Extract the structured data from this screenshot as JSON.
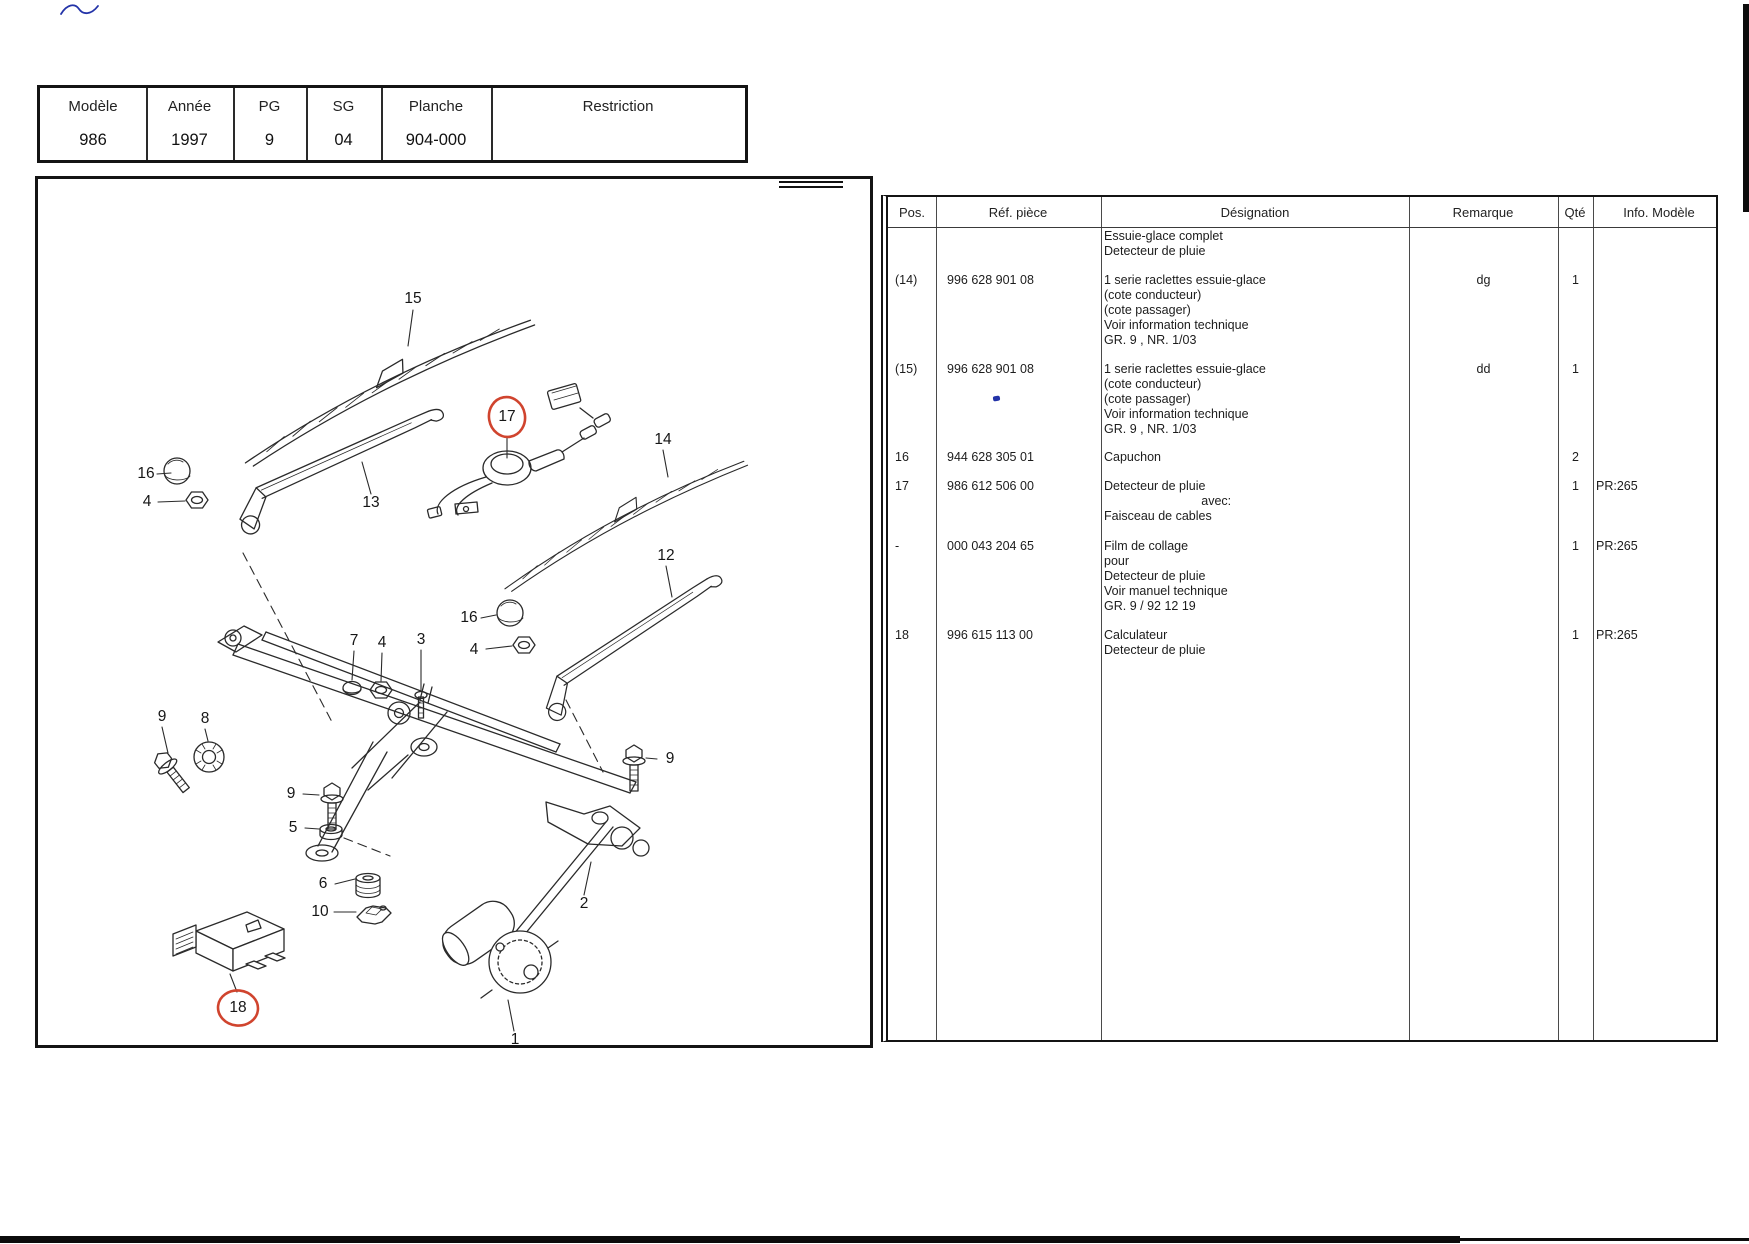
{
  "page": {
    "colors": {
      "ink": "#1f1f1f",
      "annotation_red": "#d0442e",
      "pen_blue": "#2333a8"
    }
  },
  "header_table": {
    "columns": [
      {
        "label": "Modèle",
        "value": "986"
      },
      {
        "label": "Année",
        "value": "1997"
      },
      {
        "label": "PG",
        "value": "9"
      },
      {
        "label": "SG",
        "value": "04"
      },
      {
        "label": "Planche",
        "value": "904-000"
      },
      {
        "label": "Restriction",
        "value": ""
      }
    ]
  },
  "diagram": {
    "labels": [
      {
        "text": "15",
        "circled": false
      },
      {
        "text": "16",
        "circled": false
      },
      {
        "text": "4",
        "circled": false
      },
      {
        "text": "13",
        "circled": false
      },
      {
        "text": "17",
        "circled": true
      },
      {
        "text": "14",
        "circled": false
      },
      {
        "text": "12",
        "circled": false
      },
      {
        "text": "16",
        "circled": false
      },
      {
        "text": "4",
        "circled": false
      },
      {
        "text": "7",
        "circled": false
      },
      {
        "text": "4",
        "circled": false
      },
      {
        "text": "3",
        "circled": false
      },
      {
        "text": "9",
        "circled": false
      },
      {
        "text": "8",
        "circled": false
      },
      {
        "text": "9",
        "circled": false
      },
      {
        "text": "5",
        "circled": false
      },
      {
        "text": "6",
        "circled": false
      },
      {
        "text": "10",
        "circled": false
      },
      {
        "text": "9",
        "circled": false
      },
      {
        "text": "2",
        "circled": false
      },
      {
        "text": "18",
        "circled": true
      },
      {
        "text": "1",
        "circled": false
      }
    ]
  },
  "parts_table": {
    "headers": {
      "pos": "Pos.",
      "ref": "Réf. pièce",
      "designation": "Désignation",
      "remarque": "Remarque",
      "qty": "Qté",
      "info": "Info. Modèle"
    },
    "rows": [
      {
        "pos": "",
        "ref": "",
        "designation": [
          "Essuie-glace complet",
          "Detecteur de pluie"
        ],
        "remarque": "",
        "qty": "",
        "info": ""
      },
      {
        "pos": "(14)",
        "ref": "996 628 901 08",
        "designation": [
          "1 serie raclettes essuie-glace",
          "(cote conducteur)",
          "(cote passager)",
          "Voir information technique",
          "GR. 9 , NR. 1/03"
        ],
        "remarque": "dg",
        "qty": "1",
        "info": ""
      },
      {
        "pos": "(15)",
        "ref": "996 628 901 08",
        "designation": [
          "1 serie raclettes essuie-glace",
          "(cote conducteur)",
          "(cote passager)",
          "Voir information technique",
          "GR. 9 , NR. 1/03"
        ],
        "remarque": "dd",
        "qty": "1",
        "info": ""
      },
      {
        "pos": "16",
        "ref": "944 628 305 01",
        "designation": [
          "Capuchon"
        ],
        "remarque": "",
        "qty": "2",
        "info": ""
      },
      {
        "pos": "17",
        "ref": "986 612 506 00",
        "designation": [
          "Detecteur de pluie",
          "                            avec:",
          "Faisceau de cables"
        ],
        "remarque": "",
        "qty": "1",
        "info": "PR:265"
      },
      {
        "pos": "-",
        "ref": "000 043 204 65",
        "designation": [
          "Film de collage",
          "pour",
          "Detecteur de pluie",
          "Voir manuel technique",
          "GR. 9 / 92 12 19"
        ],
        "remarque": "",
        "qty": "1",
        "info": "PR:265"
      },
      {
        "pos": "18",
        "ref": "996 615 113 00",
        "designation": [
          "Calculateur",
          "Detecteur de pluie"
        ],
        "remarque": "",
        "qty": "1",
        "info": "PR:265"
      }
    ]
  }
}
